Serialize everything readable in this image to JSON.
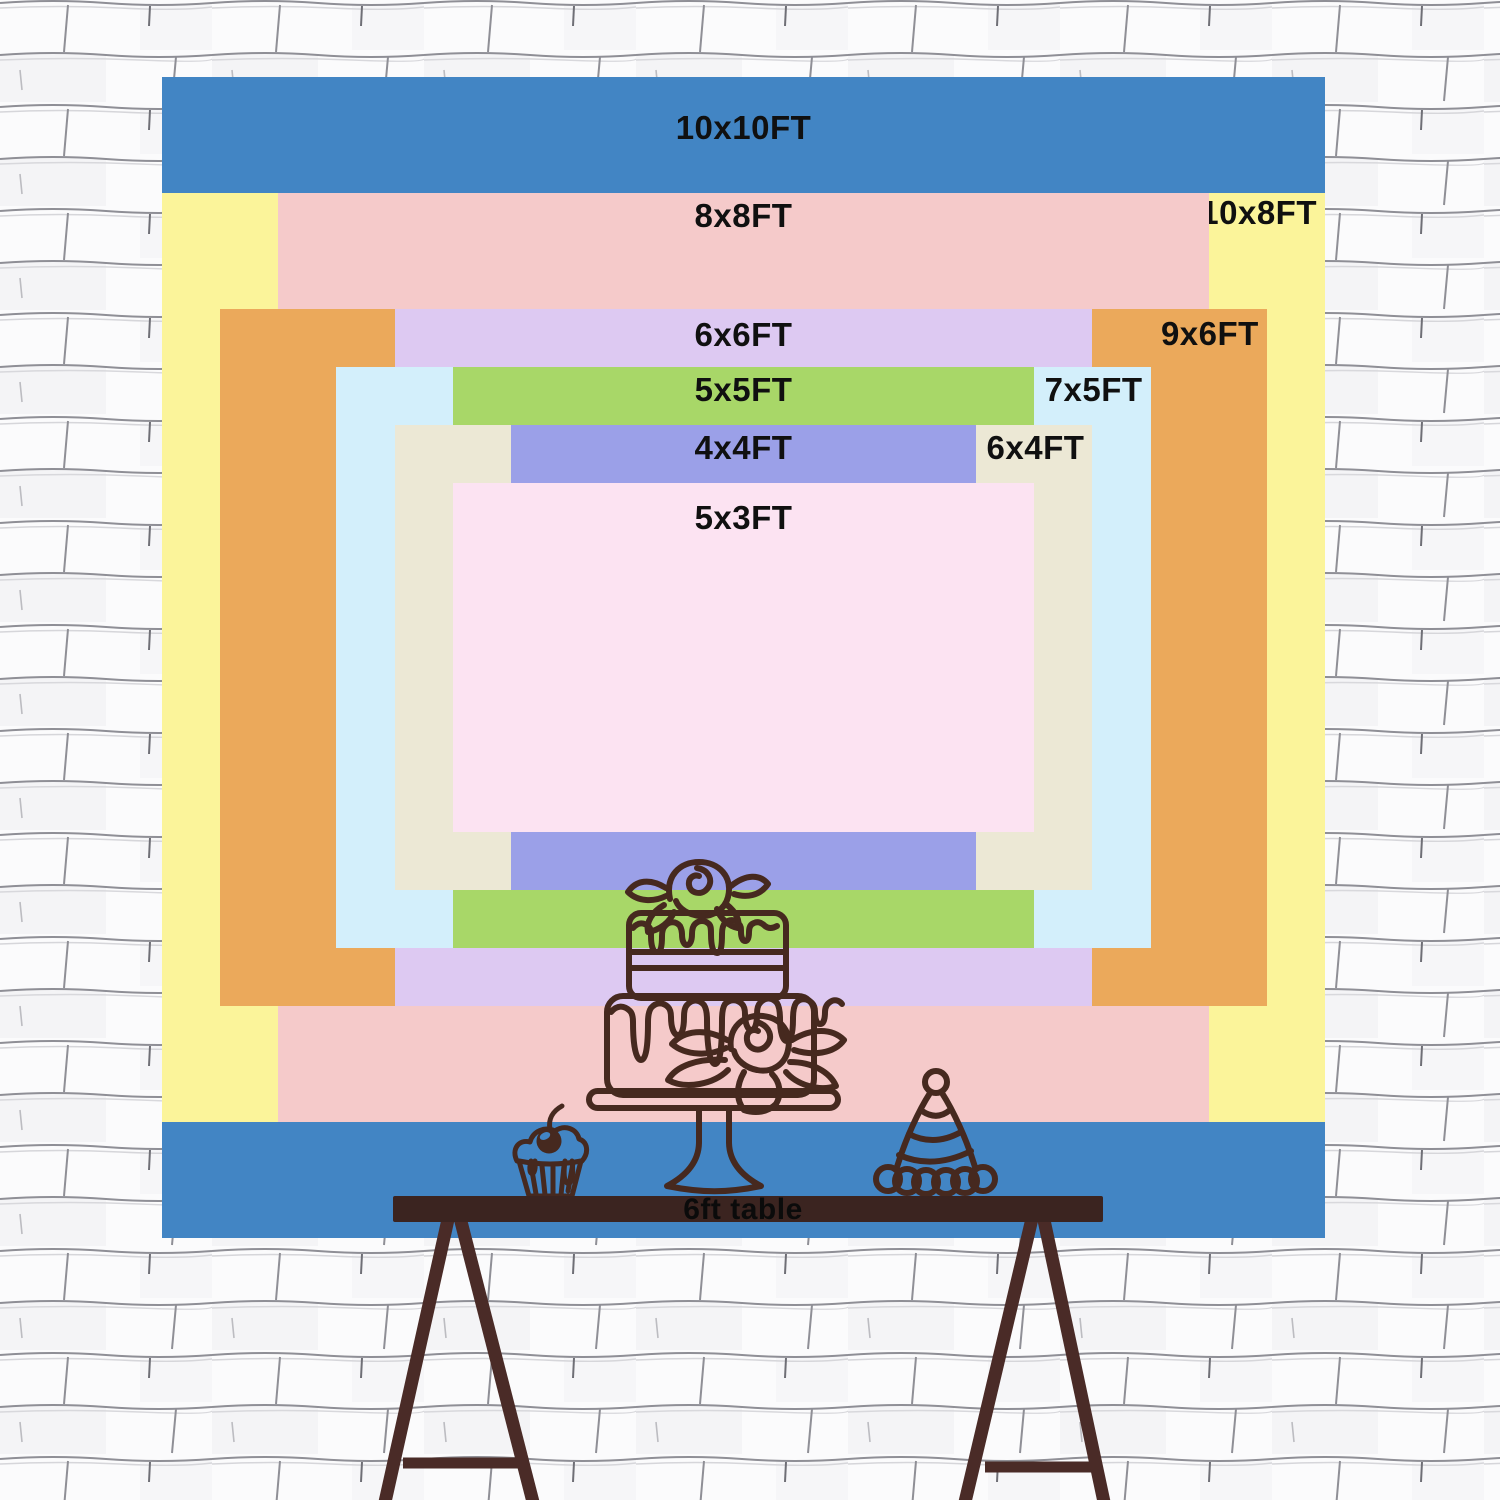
{
  "backdrop": {
    "sizes": [
      {
        "id": "10x10",
        "label": "10x10FT",
        "width_ft": 10,
        "height_ft": 10,
        "color": "#4285c4",
        "label_placement": "top-center"
      },
      {
        "id": "10x8",
        "label": "10x8FT",
        "width_ft": 10,
        "height_ft": 8,
        "color": "#fbf49a",
        "label_placement": "top-right"
      },
      {
        "id": "8x8",
        "label": "8x8FT",
        "width_ft": 8,
        "height_ft": 8,
        "color": "#f5caca",
        "label_placement": "top-center"
      },
      {
        "id": "9x6",
        "label": "9x6FT",
        "width_ft": 9,
        "height_ft": 6,
        "color": "#eba95b",
        "label_placement": "top-right"
      },
      {
        "id": "6x6",
        "label": "6x6FT",
        "width_ft": 6,
        "height_ft": 6,
        "color": "#ddc9f2",
        "label_placement": "top-center"
      },
      {
        "id": "7x5",
        "label": "7x5FT",
        "width_ft": 7,
        "height_ft": 5,
        "color": "#d3effb",
        "label_placement": "top-right"
      },
      {
        "id": "5x5",
        "label": "5x5FT",
        "width_ft": 5,
        "height_ft": 5,
        "color": "#a8d768",
        "label_placement": "top-center"
      },
      {
        "id": "6x4",
        "label": "6x4FT",
        "width_ft": 6,
        "height_ft": 4,
        "color": "#ece8d5",
        "label_placement": "top-right"
      },
      {
        "id": "4x4",
        "label": "4x4FT",
        "width_ft": 4,
        "height_ft": 4,
        "color": "#9ba0e8",
        "label_placement": "top-center"
      },
      {
        "id": "5x3",
        "label": "5x3FT",
        "width_ft": 5,
        "height_ft": 3,
        "color": "#fce3f2",
        "label_placement": "top-center"
      }
    ]
  },
  "table": {
    "label": "6ft table"
  },
  "decorations": {
    "icons": [
      "tiered-cake-icon",
      "cupcake-icon",
      "party-hat-icon"
    ]
  },
  "colors": {
    "label_text": "#101010",
    "table_wood": "#3b2420",
    "table_legs": "#4a2b27",
    "line_art": "#46291f",
    "wall_line": "#8f8f96",
    "wall_background": "#fbfbfc"
  }
}
